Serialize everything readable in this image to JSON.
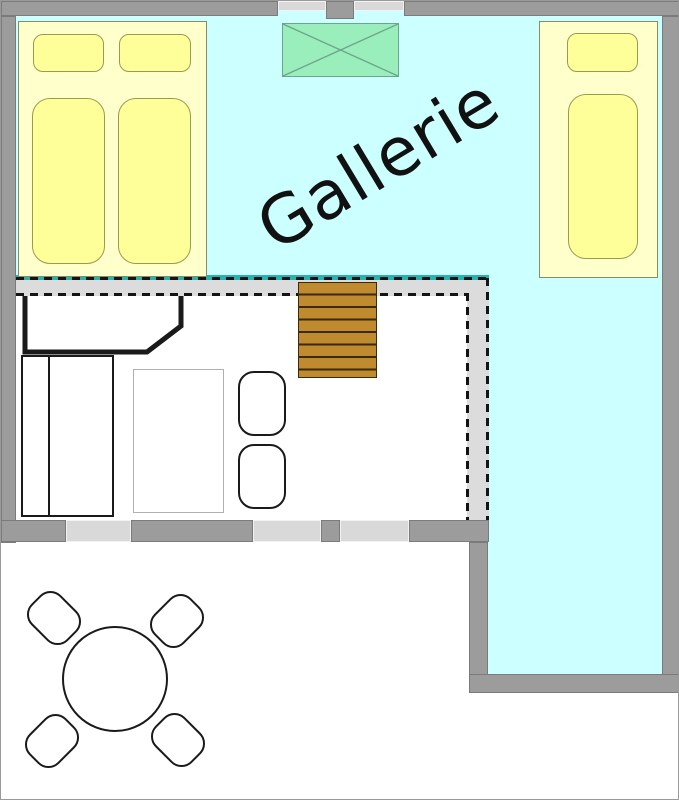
{
  "title": {
    "text": "Gallerie"
  },
  "colors": {
    "background": "#ffffff",
    "floor": "#ccffff",
    "floor_edge": "#2ab0b0",
    "wall": "#9c9c9c",
    "wall_edge": "#7b7b7b",
    "window": "#d9d9d9",
    "overhang": "#dcdcdc",
    "dash": "#141414",
    "bed_base": "#ffffcc",
    "bed_cushion": "#ffff99",
    "bed_outline": "#8b8b66",
    "cushion_outline": "#9b9b50",
    "skylight_fill": "#99eebb",
    "skylight_line": "#6fa58c",
    "stair_fill": "#bf8b2e",
    "stair_line": "#3a2a08",
    "furniture_line": "#1a1a1a",
    "table_line": "#b0b0b0"
  }
}
